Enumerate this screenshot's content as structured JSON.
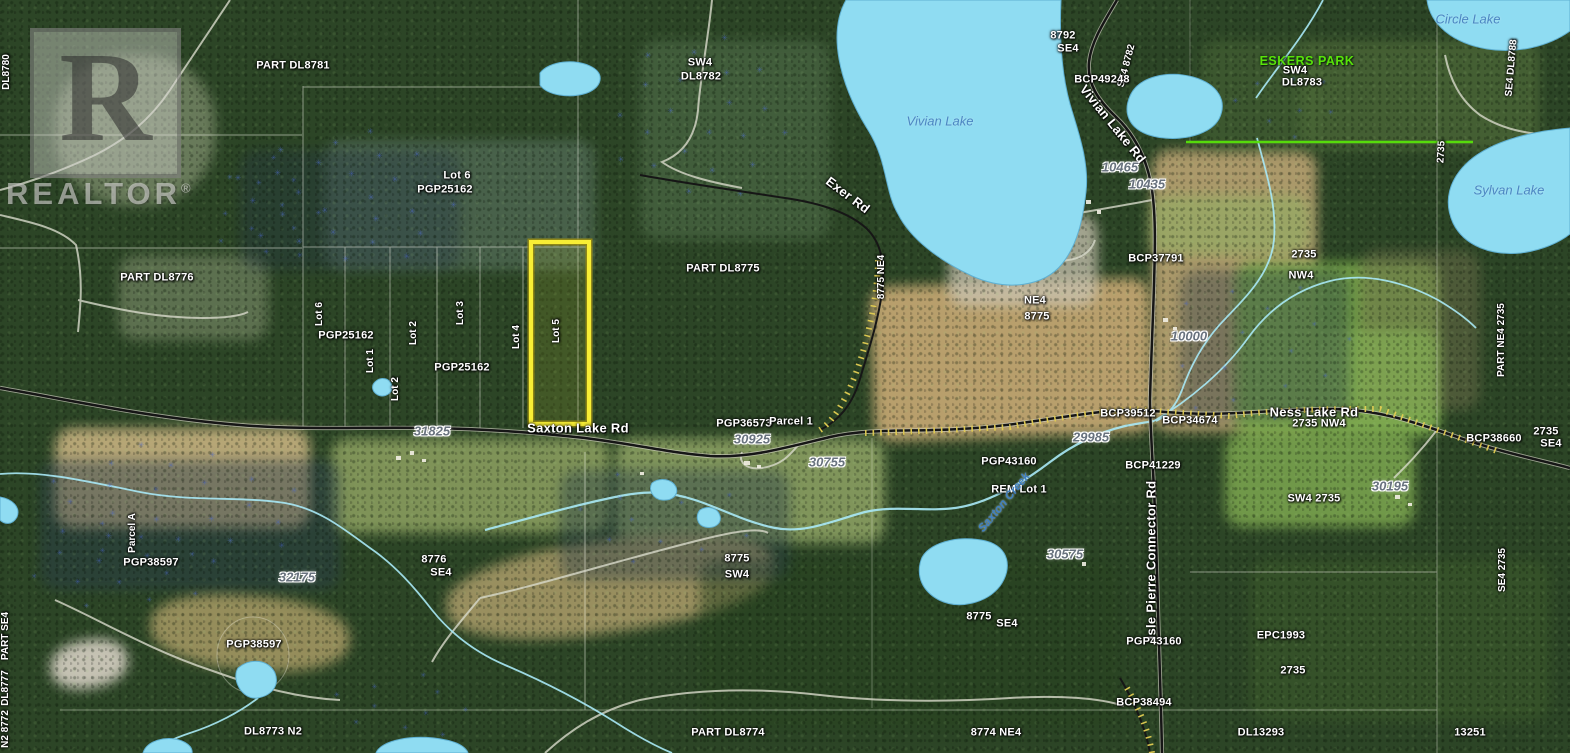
{
  "watermark": {
    "monogram": "R",
    "brand": "REALTOR",
    "registered": "®"
  },
  "map": {
    "colors": {
      "lake": "#8fdcf2",
      "lake_outline": "#5fb0d2",
      "highlight_yellow": "#f7ee35",
      "highlight_edge": "#9c8f12",
      "park_green": "#58e20a",
      "road_black": "#161616",
      "road_casing": "#cfcfc0",
      "road_hatch": "#e3ce52",
      "gravel_road": "#d8dacb",
      "creek": "#a9e9f7",
      "grid_line": "#f0f0e6"
    },
    "labels": [
      {
        "t": "DL8780",
        "x": 7,
        "y": 72,
        "c": "parcel-sm",
        "r": -90
      },
      {
        "t": "PART DL8781",
        "x": 293,
        "y": 66,
        "c": "parcel",
        "r": 0
      },
      {
        "t": "SW4",
        "x": 700,
        "y": 63,
        "c": "parcel",
        "r": 0
      },
      {
        "t": "DL8782",
        "x": 701,
        "y": 77,
        "c": "parcel",
        "r": 0
      },
      {
        "t": "8792",
        "x": 1063,
        "y": 36,
        "c": "parcel",
        "r": 0
      },
      {
        "t": "SE4",
        "x": 1068,
        "y": 49,
        "c": "parcel",
        "r": 0
      },
      {
        "t": "SE4 8782",
        "x": 1127,
        "y": 66,
        "c": "parcel-sm",
        "r": -75
      },
      {
        "t": "BCP49248",
        "x": 1102,
        "y": 80,
        "c": "parcel",
        "r": 0
      },
      {
        "t": "Vivian Lake Rd",
        "x": 1113,
        "y": 124,
        "c": "road",
        "r": 51
      },
      {
        "t": "ESKERS PARK",
        "x": 1307,
        "y": 61,
        "c": "park",
        "r": 0
      },
      {
        "t": "SW4",
        "x": 1295,
        "y": 71,
        "c": "parcel",
        "r": 0
      },
      {
        "t": "DL8783",
        "x": 1302,
        "y": 83,
        "c": "parcel",
        "r": 0
      },
      {
        "t": "Circle Lake",
        "x": 1468,
        "y": 19,
        "c": "lake",
        "r": 0
      },
      {
        "t": "SE4 DL8788",
        "x": 1512,
        "y": 68,
        "c": "parcel-sm",
        "r": -85
      },
      {
        "t": "2735",
        "x": 1442,
        "y": 152,
        "c": "parcel-sm",
        "r": -87
      },
      {
        "t": "Sylvan Lake",
        "x": 1509,
        "y": 190,
        "c": "lake",
        "r": 0
      },
      {
        "t": "Vivian Lake",
        "x": 940,
        "y": 121,
        "c": "lake",
        "r": 0
      },
      {
        "t": "Exer Rd",
        "x": 848,
        "y": 195,
        "c": "road",
        "r": 37
      },
      {
        "t": "10465",
        "x": 1120,
        "y": 167,
        "c": "addr",
        "r": 0
      },
      {
        "t": "10435",
        "x": 1147,
        "y": 184,
        "c": "addr",
        "r": 0
      },
      {
        "t": "Lot 6",
        "x": 457,
        "y": 176,
        "c": "parcel",
        "r": 0
      },
      {
        "t": "PGP25162",
        "x": 445,
        "y": 190,
        "c": "parcel",
        "r": 0
      },
      {
        "t": "PART DL8776",
        "x": 157,
        "y": 278,
        "c": "parcel",
        "r": 0
      },
      {
        "t": "Lot 6",
        "x": 320,
        "y": 314,
        "c": "parcel-sm",
        "r": -90
      },
      {
        "t": "PGP25162",
        "x": 346,
        "y": 336,
        "c": "parcel",
        "r": 0
      },
      {
        "t": "Lot 1",
        "x": 371,
        "y": 361,
        "c": "parcel-sm",
        "r": -90
      },
      {
        "t": "Lot 2",
        "x": 414,
        "y": 333,
        "c": "parcel-sm",
        "r": -90
      },
      {
        "t": "Lot 2",
        "x": 396,
        "y": 389,
        "c": "parcel-sm",
        "r": -90
      },
      {
        "t": "Lot 3",
        "x": 461,
        "y": 313,
        "c": "parcel-sm",
        "r": -90
      },
      {
        "t": "Lot 4",
        "x": 517,
        "y": 337,
        "c": "parcel-sm",
        "r": -90
      },
      {
        "t": "Lot 5",
        "x": 557,
        "y": 331,
        "c": "parcel-sm",
        "r": -90
      },
      {
        "t": "PGP25162",
        "x": 462,
        "y": 368,
        "c": "parcel",
        "r": 0
      },
      {
        "t": "PART DL8775",
        "x": 723,
        "y": 269,
        "c": "parcel",
        "r": 0
      },
      {
        "t": "8775 NE4",
        "x": 882,
        "y": 277,
        "c": "parcel-sm",
        "r": -90
      },
      {
        "t": "NE4",
        "x": 1035,
        "y": 301,
        "c": "parcel",
        "r": 0
      },
      {
        "t": "8775",
        "x": 1037,
        "y": 317,
        "c": "parcel",
        "r": 0
      },
      {
        "t": "BCP37791",
        "x": 1156,
        "y": 259,
        "c": "parcel",
        "r": 0
      },
      {
        "t": "10000",
        "x": 1189,
        "y": 336,
        "c": "addr",
        "r": 0
      },
      {
        "t": "2735",
        "x": 1304,
        "y": 255,
        "c": "parcel",
        "r": 0
      },
      {
        "t": "NW4",
        "x": 1301,
        "y": 276,
        "c": "parcel",
        "r": 0
      },
      {
        "t": "PART NE4 2735",
        "x": 1502,
        "y": 340,
        "c": "parcel-sm",
        "r": -90
      },
      {
        "t": "Saxton Lake Rd",
        "x": 578,
        "y": 428,
        "c": "road",
        "r": 0
      },
      {
        "t": "31825",
        "x": 432,
        "y": 431,
        "c": "addr",
        "r": 0
      },
      {
        "t": "PGP36573",
        "x": 744,
        "y": 424,
        "c": "parcel",
        "r": 0
      },
      {
        "t": "Parcel 1",
        "x": 791,
        "y": 422,
        "c": "parcel",
        "r": 0
      },
      {
        "t": "30925",
        "x": 752,
        "y": 439,
        "c": "addr",
        "r": 0
      },
      {
        "t": "30755",
        "x": 827,
        "y": 462,
        "c": "addr",
        "r": 0
      },
      {
        "t": "BCP39512",
        "x": 1128,
        "y": 414,
        "c": "parcel",
        "r": 0
      },
      {
        "t": "BCP34674",
        "x": 1190,
        "y": 421,
        "c": "parcel",
        "r": 0
      },
      {
        "t": "29985",
        "x": 1091,
        "y": 437,
        "c": "addr",
        "r": 0
      },
      {
        "t": "Ness Lake Rd",
        "x": 1314,
        "y": 412,
        "c": "road",
        "r": 0
      },
      {
        "t": "2735 NW4",
        "x": 1319,
        "y": 424,
        "c": "parcel",
        "r": 0
      },
      {
        "t": "BCP38660",
        "x": 1494,
        "y": 439,
        "c": "parcel",
        "r": 0
      },
      {
        "t": "2735",
        "x": 1546,
        "y": 432,
        "c": "parcel",
        "r": 0
      },
      {
        "t": "SE4",
        "x": 1551,
        "y": 444,
        "c": "parcel",
        "r": 0
      },
      {
        "t": "Parcel A",
        "x": 133,
        "y": 533,
        "c": "parcel-sm",
        "r": -90
      },
      {
        "t": "PGP38597",
        "x": 151,
        "y": 563,
        "c": "parcel",
        "r": 0
      },
      {
        "t": "32175",
        "x": 297,
        "y": 577,
        "c": "addr",
        "r": 0
      },
      {
        "t": "PGP38597",
        "x": 254,
        "y": 645,
        "c": "parcel",
        "r": 0
      },
      {
        "t": "PART SE4",
        "x": 6,
        "y": 636,
        "c": "parcel-sm",
        "r": -90
      },
      {
        "t": "DL8777",
        "x": 6,
        "y": 688,
        "c": "parcel-sm",
        "r": -90
      },
      {
        "t": "N2 8772",
        "x": 6,
        "y": 729,
        "c": "parcel-sm",
        "r": -90
      },
      {
        "t": "8776",
        "x": 434,
        "y": 560,
        "c": "parcel",
        "r": 0
      },
      {
        "t": "SE4",
        "x": 441,
        "y": 573,
        "c": "parcel",
        "r": 0
      },
      {
        "t": "8775",
        "x": 737,
        "y": 559,
        "c": "parcel",
        "r": 0
      },
      {
        "t": "SW4",
        "x": 737,
        "y": 575,
        "c": "parcel",
        "r": 0
      },
      {
        "t": "PGP43160",
        "x": 1009,
        "y": 462,
        "c": "parcel",
        "r": 0
      },
      {
        "t": "REM Lot 1",
        "x": 1019,
        "y": 490,
        "c": "parcel",
        "r": 0
      },
      {
        "t": "Saxton Creek",
        "x": 1005,
        "y": 503,
        "c": "creek",
        "r": -50
      },
      {
        "t": "30575",
        "x": 1065,
        "y": 554,
        "c": "addr",
        "r": 0
      },
      {
        "t": "Isle Pierre Connector Rd",
        "x": 1151,
        "y": 560,
        "c": "road",
        "r": -90
      },
      {
        "t": "BCP41229",
        "x": 1153,
        "y": 466,
        "c": "parcel",
        "r": 0
      },
      {
        "t": "PGP43160",
        "x": 1154,
        "y": 642,
        "c": "parcel",
        "r": 0
      },
      {
        "t": "BCP38494",
        "x": 1144,
        "y": 703,
        "c": "parcel",
        "r": 0
      },
      {
        "t": "8775",
        "x": 979,
        "y": 617,
        "c": "parcel",
        "r": 0
      },
      {
        "t": "SE4",
        "x": 1007,
        "y": 624,
        "c": "parcel",
        "r": 0
      },
      {
        "t": "30195",
        "x": 1390,
        "y": 486,
        "c": "addr",
        "r": 0
      },
      {
        "t": "SW4 2735",
        "x": 1314,
        "y": 499,
        "c": "parcel",
        "r": 0
      },
      {
        "t": "SE4 2735",
        "x": 1503,
        "y": 570,
        "c": "parcel-sm",
        "r": -90
      },
      {
        "t": "EPC1993",
        "x": 1281,
        "y": 636,
        "c": "parcel",
        "r": 0
      },
      {
        "t": "2735",
        "x": 1293,
        "y": 671,
        "c": "parcel",
        "r": 0
      },
      {
        "t": "DL13293",
        "x": 1261,
        "y": 733,
        "c": "parcel",
        "r": 0
      },
      {
        "t": "13251",
        "x": 1470,
        "y": 733,
        "c": "parcel",
        "r": 0
      },
      {
        "t": "DL8773 N2",
        "x": 273,
        "y": 732,
        "c": "parcel",
        "r": 0
      },
      {
        "t": "PART DL8774",
        "x": 728,
        "y": 733,
        "c": "parcel",
        "r": 0
      },
      {
        "t": "8774  NE4",
        "x": 996,
        "y": 733,
        "c": "parcel",
        "r": 0
      }
    ]
  }
}
